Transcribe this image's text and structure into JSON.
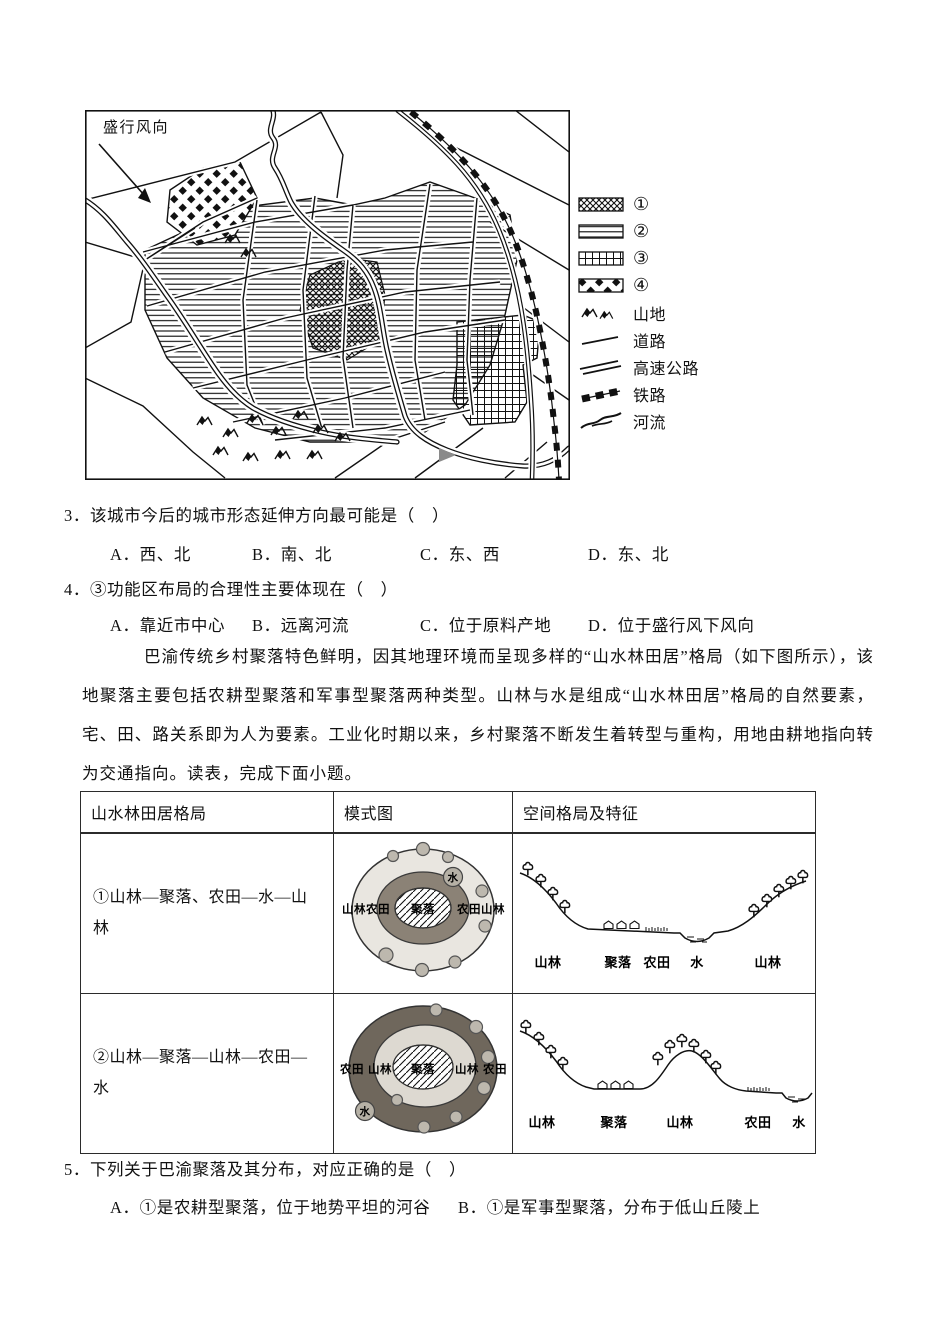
{
  "figure": {
    "wind_label": "盛行风向",
    "legend_items": [
      {
        "label": "①"
      },
      {
        "label": "②"
      },
      {
        "label": "③"
      },
      {
        "label": "④"
      },
      {
        "label": "山地"
      },
      {
        "label": "道路"
      },
      {
        "label": "高速公路"
      },
      {
        "label": "铁路"
      },
      {
        "label": "河流"
      }
    ]
  },
  "questions": {
    "q3": {
      "stem": "3．该城市今后的城市形态延伸方向最可能是（　）",
      "options": [
        "A．西、北",
        "B．南、北",
        "C．东、西",
        "D．东、北"
      ]
    },
    "q4": {
      "stem": "4．③功能区布局的合理性主要体现在（　）",
      "options": [
        "A．靠近市中心",
        "B．远离河流",
        "C．位于原料产地",
        "D．位于盛行风下风向"
      ]
    },
    "q5": {
      "stem": "5．下列关于巴渝聚落及其分布，对应正确的是（　）",
      "options": [
        "A．①是农耕型聚落，位于地势平坦的河谷",
        "B．①是军事型聚落，分布于低山丘陵上"
      ]
    }
  },
  "passage": "巴渝传统乡村聚落特色鲜明，因其地理环境而呈现多样的“山水林田居”格局（如下图所示），该地聚落主要包括农耕型聚落和军事型聚落两种类型。山林与水是组成“山水林田居”格局的自然要素，宅、田、路关系即为人为要素。工业化时期以来，乡村聚落不断发生着转型与重构，用地由耕地指向转为交通指向。读表，完成下面小题。",
  "table": {
    "headers": [
      "山水林田居格局",
      "模式图",
      "空间格局及特征"
    ],
    "rows": [
      {
        "pattern": "①山林—聚落、农田—水—山林",
        "model_labels": {
          "left": "山林农田",
          "center": "聚落",
          "right": "农田山林",
          "water": "水"
        },
        "section_labels": [
          "山林",
          "聚落",
          "农田",
          "水",
          "山林"
        ]
      },
      {
        "pattern": "②山林—聚落—山林—农田—水",
        "model_labels": {
          "l1": "农田",
          "l2": "山林",
          "center": "聚落",
          "r2": "山林",
          "r1": "农田",
          "water": "水"
        },
        "section_labels": [
          "山林",
          "聚落",
          "山林",
          "农田",
          "水"
        ]
      }
    ]
  }
}
